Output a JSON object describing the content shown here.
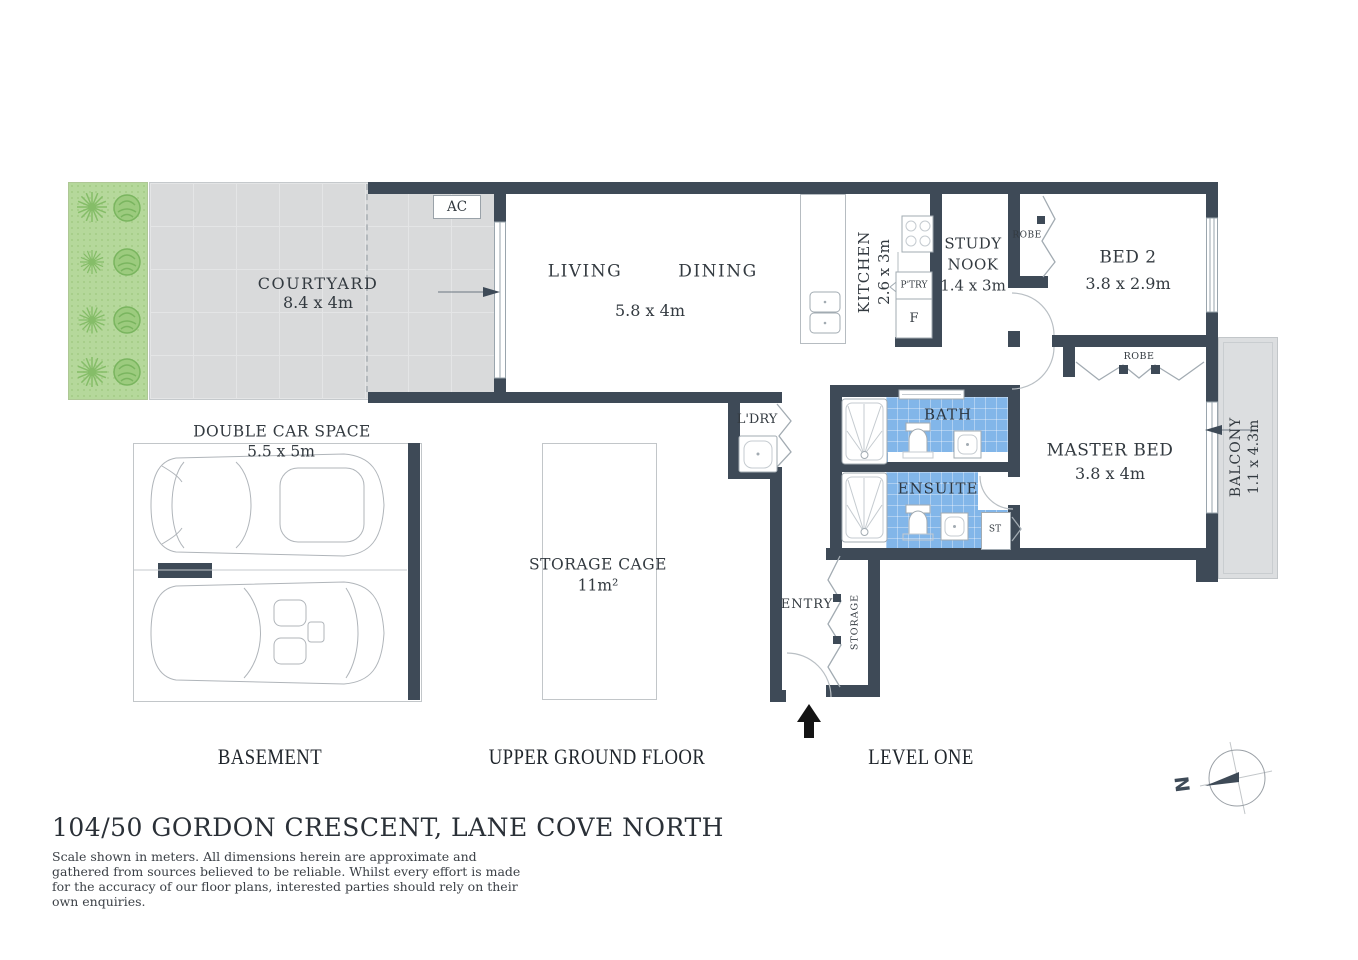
{
  "title": "104/50 GORDON CRESCENT, LANE COVE NORTH",
  "disclaimer": "Scale shown in meters. All dimensions herein are approximate and gathered from sources believed to be reliable. Whilst every effort is made for the accuracy of our floor plans, interested parties should rely on their own enquiries.",
  "floor_labels": {
    "basement": "BASEMENT",
    "upper_ground": "UPPER GROUND FLOOR",
    "level_one": "LEVEL ONE"
  },
  "rooms": {
    "courtyard": {
      "name": "COURTYARD",
      "dims": "8.4 x 4m"
    },
    "living": {
      "name": "LIVING"
    },
    "dining": {
      "name": "DINING"
    },
    "living_dining_dims": "5.8 x 4m",
    "kitchen": {
      "name": "KITCHEN",
      "dims": "2.6 x 3m"
    },
    "study_nook": {
      "line1": "STUDY",
      "line2": "NOOK",
      "dims": "1.4 x 3m"
    },
    "bed2": {
      "name": "BED 2",
      "dims": "3.8 x 2.9m"
    },
    "master_bed": {
      "name": "MASTER BED",
      "dims": "3.8 x 4m"
    },
    "balcony": {
      "name": "BALCONY",
      "dims": "1.1 x 4.3m"
    },
    "bath": {
      "name": "BATH"
    },
    "ensuite": {
      "name": "ENSUITE"
    },
    "laundry": {
      "name": "L'DRY"
    },
    "entry": {
      "name": "ENTRY"
    },
    "storage": {
      "name": "STORAGE"
    },
    "double_car_space": {
      "name": "DOUBLE CAR SPACE",
      "dims": "5.5 x 5m"
    },
    "storage_cage": {
      "name": "STORAGE CAGE",
      "dims": "11m²"
    }
  },
  "labels": {
    "ac": "AC",
    "pantry": "P'TRY",
    "fridge": "F",
    "robe_bed2": "ROBE",
    "robe_master": "ROBE",
    "st": "ST"
  },
  "compass": {
    "north": "N"
  },
  "colors": {
    "wall": "#3e4a57",
    "tile_blue": "#82b6e9",
    "garden": "#b5d89b",
    "plant": "#8cc474",
    "paving": "#d9dadb",
    "balcony": "#dcdee0",
    "text": "#333a40"
  }
}
